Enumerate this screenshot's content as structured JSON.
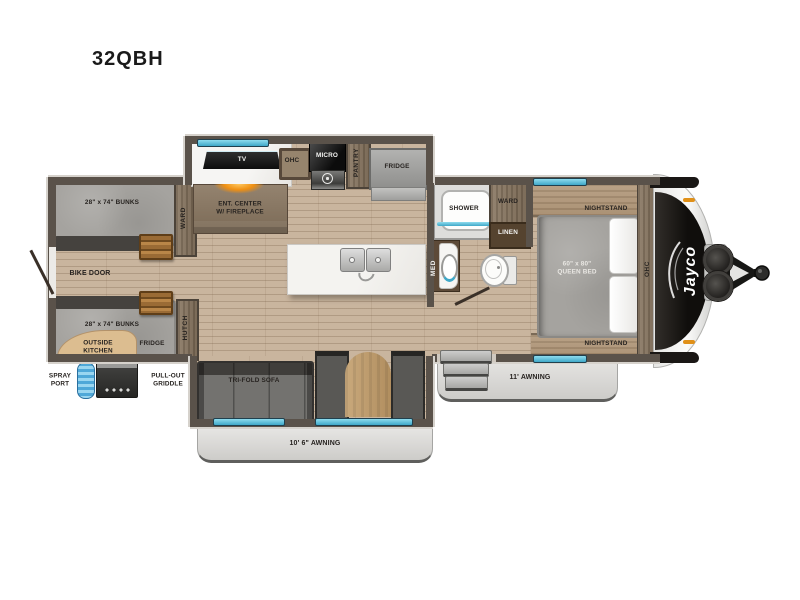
{
  "title": "32QBH",
  "brand": "Jayco",
  "labels": {
    "kitchen": {
      "tv": "TV",
      "ohc": "OHC",
      "micro": "MICRO",
      "pantry": "PANTRY",
      "fridge": "FRIDGE",
      "ent_center": "ENT. CENTER\nW/ FIREPLACE",
      "ward": "WARD"
    },
    "bunk_room": {
      "bunk_top": "28\" x 74\" BUNKS",
      "bunk_bottom": "28\" x 74\" BUNKS",
      "bike_door": "BIKE DOOR",
      "hutch": "HUTCH",
      "outside_kitchen": "OUTSIDE\nKITCHEN",
      "outside_fridge": "FRIDGE",
      "spray_port": "SPRAY\nPORT",
      "griddle": "PULL-OUT\nGRIDDLE"
    },
    "living": {
      "sofa": "TRI-FOLD SOFA",
      "awning": "10' 6\" AWNING"
    },
    "bath": {
      "shower": "SHOWER",
      "ward": "WARD",
      "linen": "LINEN",
      "med": "MED"
    },
    "bedroom": {
      "bed": "60\" x 80\"\nQUEEN BED",
      "nightstand_top": "NIGHTSTAND",
      "nightstand_bottom": "NIGHTSTAND",
      "ohc": "OHC",
      "awning": "11' AWNING"
    }
  },
  "colors": {
    "wall": "#5a524a",
    "floor_wood": "#c9b59e",
    "cabinet_wood": "#84735f",
    "window_glass": "#54c2dc",
    "mattress_gray": "#a5a39f",
    "fireplace_orange": "#f09a18",
    "awning_gray": "#d9d8d6",
    "front_cap_black": "#14110f",
    "marker_light_orange": "#e09018"
  }
}
